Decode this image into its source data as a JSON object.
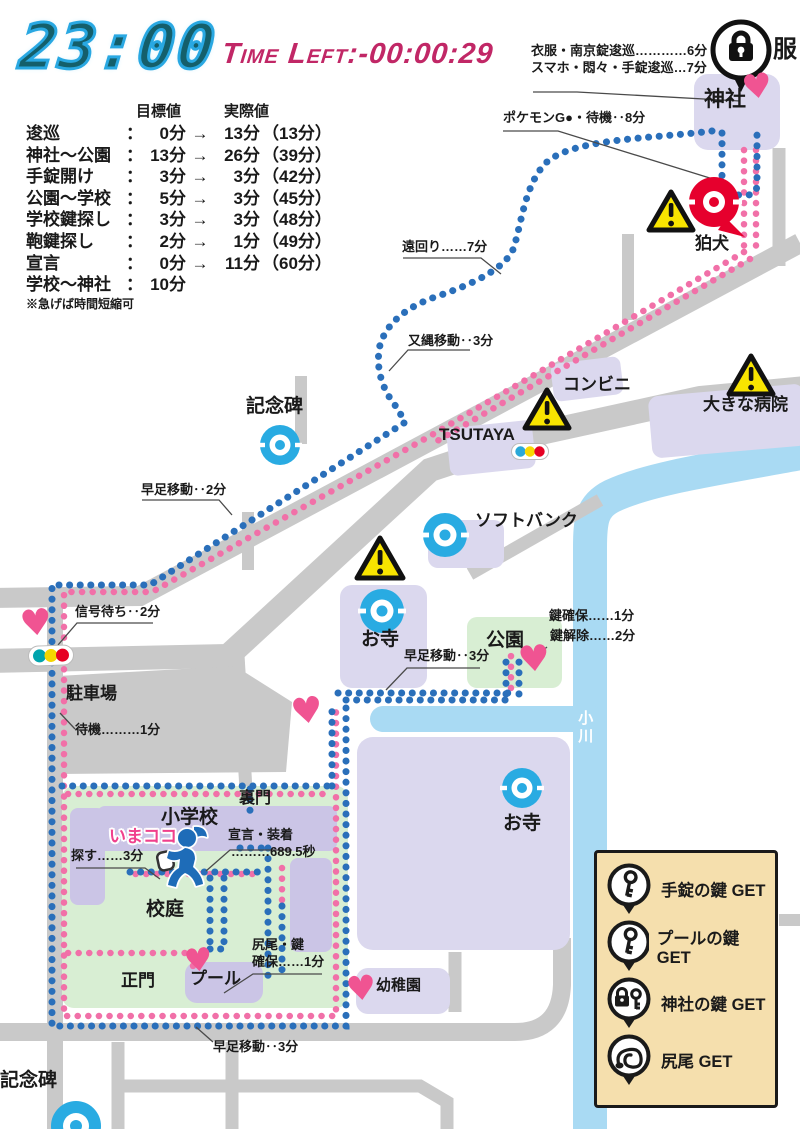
{
  "header": {
    "clock": "23:00",
    "time_left": "Time Left:-00:00:29",
    "col_target": "目標値",
    "col_actual": "実際値",
    "sep": "：",
    "schedule": [
      {
        "name": "逡巡",
        "target": "0分",
        "arrow": "→",
        "actual": "13分",
        "total": "（13分）"
      },
      {
        "name": "神社～公園",
        "target": "13分",
        "arrow": "→",
        "actual": "26分",
        "total": "（39分）"
      },
      {
        "name": "手錠開け",
        "target": "3分",
        "arrow": "→",
        "actual": "3分",
        "total": "（42分）"
      },
      {
        "name": "公園～学校",
        "target": "5分",
        "arrow": "→",
        "actual": "3分",
        "total": "（45分）"
      },
      {
        "name": "学校鍵探し",
        "target": "3分",
        "arrow": "→",
        "actual": "3分",
        "total": "（48分）"
      },
      {
        "name": "鞄鍵探し",
        "target": "2分",
        "arrow": "→",
        "actual": "1分",
        "total": "（49分）"
      },
      {
        "name": "宣言",
        "target": "0分",
        "arrow": "→",
        "actual": "11分",
        "total": "（60分）"
      },
      {
        "name": "学校～神社",
        "target": "10分",
        "arrow": "",
        "actual": "",
        "total": ""
      }
    ],
    "note": "※急げば時間短縮可"
  },
  "map": {
    "labels": {
      "fuku": "服",
      "jinja": "神社",
      "koma": "狛犬",
      "kinenhi_top": "記念碑",
      "conbini": "コンビニ",
      "tsutaya": "TSUTAYA",
      "hospital": "大きな病院",
      "softbank": "ソフトバンク",
      "otera_up": "お寺",
      "kouen": "公園",
      "chushajo": "駐車場",
      "ogawa": "小川",
      "otera_low": "お寺",
      "uramon": "裏門",
      "shougakkou": "小学校",
      "imakoko": "いまココ",
      "koutei": "校庭",
      "seimon": "正門",
      "pool": "プール",
      "youchien": "幼稚園",
      "kinenhi_btm": "記念碑"
    },
    "notes": {
      "ifuku": "衣服・南京錠逡巡…………6分",
      "sumaho": "スマホ・悶々・手錠逡巡…7分",
      "pokemon": "ポケモンG●・待機‥8分",
      "toomawari": "遠回り……7分",
      "matanawa": "又縄移動‥3分",
      "hayaashi2": "早足移動‥2分",
      "shingo": "信号待ち‥2分",
      "taiki": "待機………1分",
      "kagi_kakuho": "鍵確保……1分",
      "kagi_kaijo": "鍵解除……2分",
      "hayaashi3_park": "早足移動‥3分",
      "sagasu": "探す……3分",
      "sengen1": "宣言・装着",
      "sengen2": "………689.5秒",
      "shippo1": "尻尾・鍵",
      "shippo2": "確保……1分",
      "hayaashi3_btm": "早足移動‥3分"
    }
  },
  "legend": {
    "items": [
      {
        "icon": "key-icon",
        "label": "手錠の鍵 GET"
      },
      {
        "icon": "key-icon",
        "label": "プールの鍵 GET"
      },
      {
        "icon": "lock-key-icon",
        "label": "神社の鍵 GET"
      },
      {
        "icon": "tail-icon",
        "label": "尻尾 GET"
      }
    ]
  },
  "colors": {
    "route_blue": "#2a6fba",
    "route_pink": "#f170a8",
    "building": "#dbd8ee",
    "school_building": "#cbc5e6",
    "green_area": "#d8eed3",
    "road": "#c9c9c9",
    "river": "#a9daf3",
    "heart": "#f05492",
    "stop_blue": "#29abe2",
    "gym_red": "#e6002d",
    "warning_yellow": "#f8e400",
    "legend_bg": "#f5dfad",
    "clock_blue": "#29a8e2",
    "time_left_red": "#c12766"
  }
}
